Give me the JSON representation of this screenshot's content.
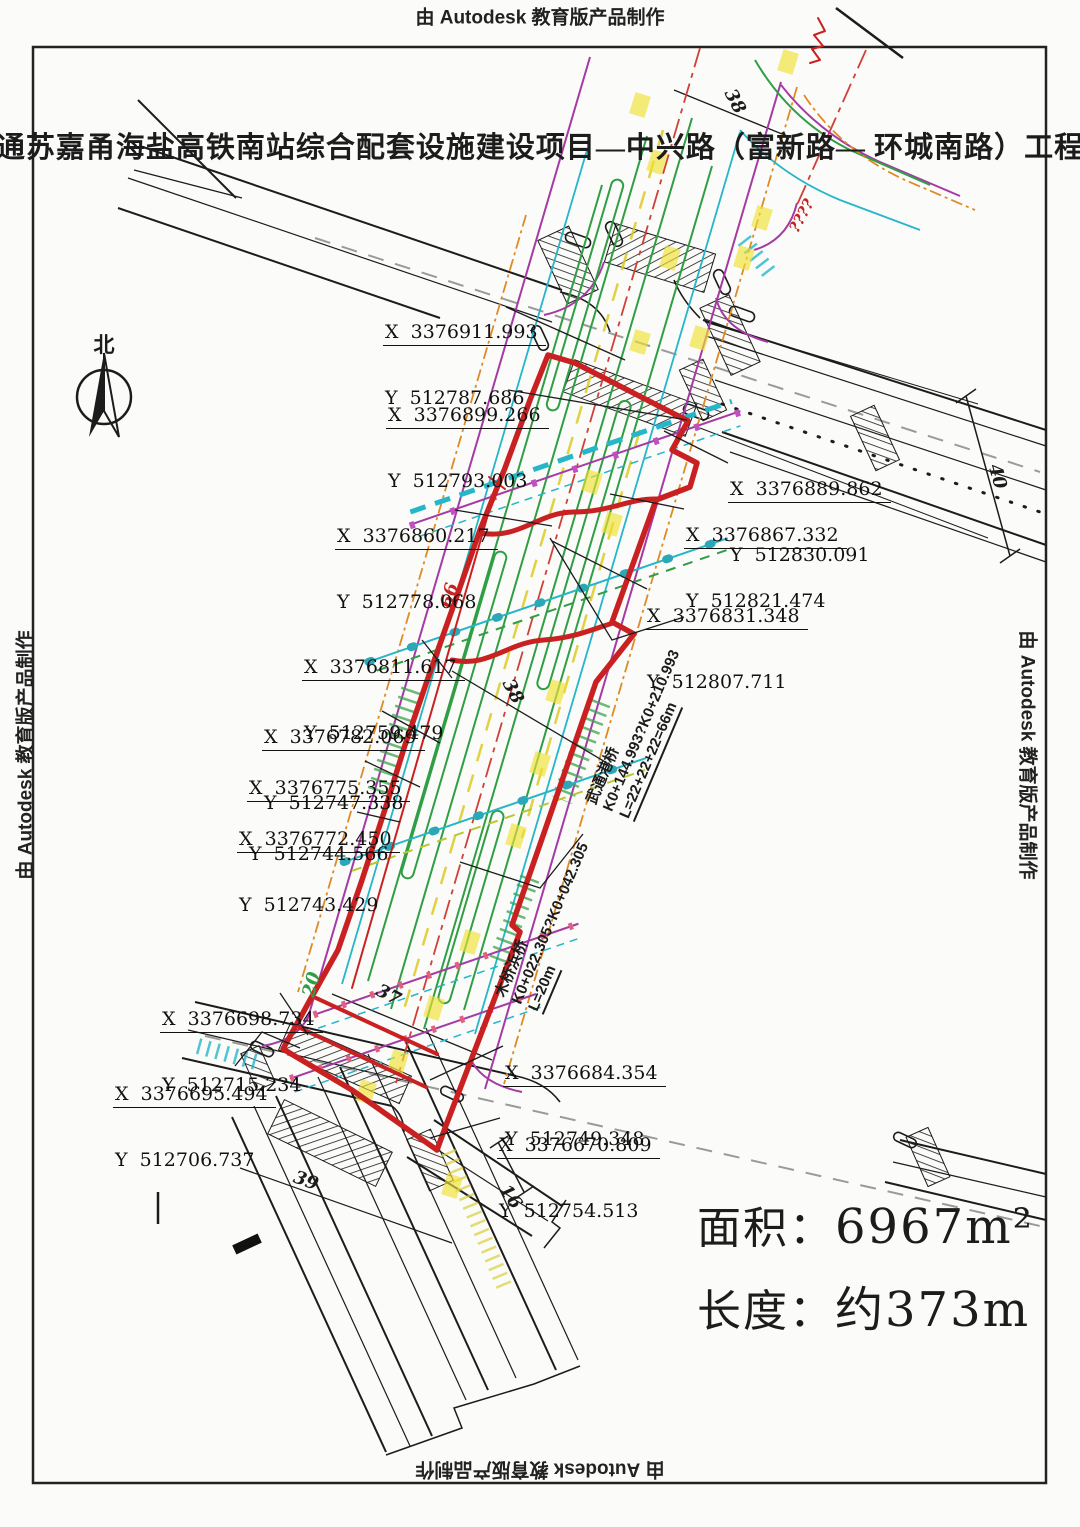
{
  "watermark": "由 Autodesk 教育版产品制作",
  "title": "通苏嘉甬海盐高铁南站综合配套设施建设项目—中兴路（富新路— 环城南路）工程",
  "compass": {
    "label": "北"
  },
  "summary": {
    "area_label": "面积：",
    "area_value": "6967m²",
    "length_label": "长度：",
    "length_value": "约373m"
  },
  "coordinates": [
    {
      "x": "X  3376911.993",
      "y": "Y  512787.686"
    },
    {
      "x": "X  3376899.266",
      "y": "Y  512793.003"
    },
    {
      "x": "X  3376889.862",
      "y": "Y  512830.091"
    },
    {
      "x": "X  3376860.217",
      "y": "Y  512778.068"
    },
    {
      "x": "X  3376867.332",
      "y": "Y  512821.474"
    },
    {
      "x": "X  3376831.348",
      "y": "Y  512807.711"
    },
    {
      "x": "X  3376811.617",
      "y": "Y  512759.479"
    },
    {
      "x": "X  3376782.069",
      "y": "Y  512747.338"
    },
    {
      "x": "X  3376775.355",
      "y": "Y  512744.566"
    },
    {
      "x": "X  3376772.450",
      "y": "Y  512743.429"
    },
    {
      "x": "X  3376698.734",
      "y": "Y  512715.234"
    },
    {
      "x": "X  3376695.494",
      "y": "Y  512706.737"
    },
    {
      "x": "X  3376684.354",
      "y": "Y  512749.348"
    },
    {
      "x": "X  3376670.809",
      "y": "Y  512754.513"
    }
  ],
  "bridges": [
    {
      "name": "武通港桥",
      "chainage": "K0+144.993?K0+210.993",
      "length": "L=22+22+22=66m"
    },
    {
      "name": "木桥浜桥",
      "chainage": "K0+022.305?K0+042.305",
      "length": "L=20m"
    }
  ],
  "dimensions": {
    "top_road_width": "38",
    "right_road_width": "40",
    "mid_road_width": "38",
    "red_line_length": "66",
    "green_width": "20",
    "lower_width": "37",
    "leg_road_width": "39",
    "bottom_right_width": "16"
  },
  "annotations": {
    "red_marks": "????"
  },
  "palette": {
    "boundary_red": "#c92121",
    "magenta": "#a53aa5",
    "green": "#2f9e44",
    "cyan": "#25b6c9",
    "orange": "#e08a25",
    "yellow": "#e0d030",
    "centerline_red": "#d04038",
    "linework": "#1c1c1c",
    "gray_dash": "#9a9a9a"
  }
}
